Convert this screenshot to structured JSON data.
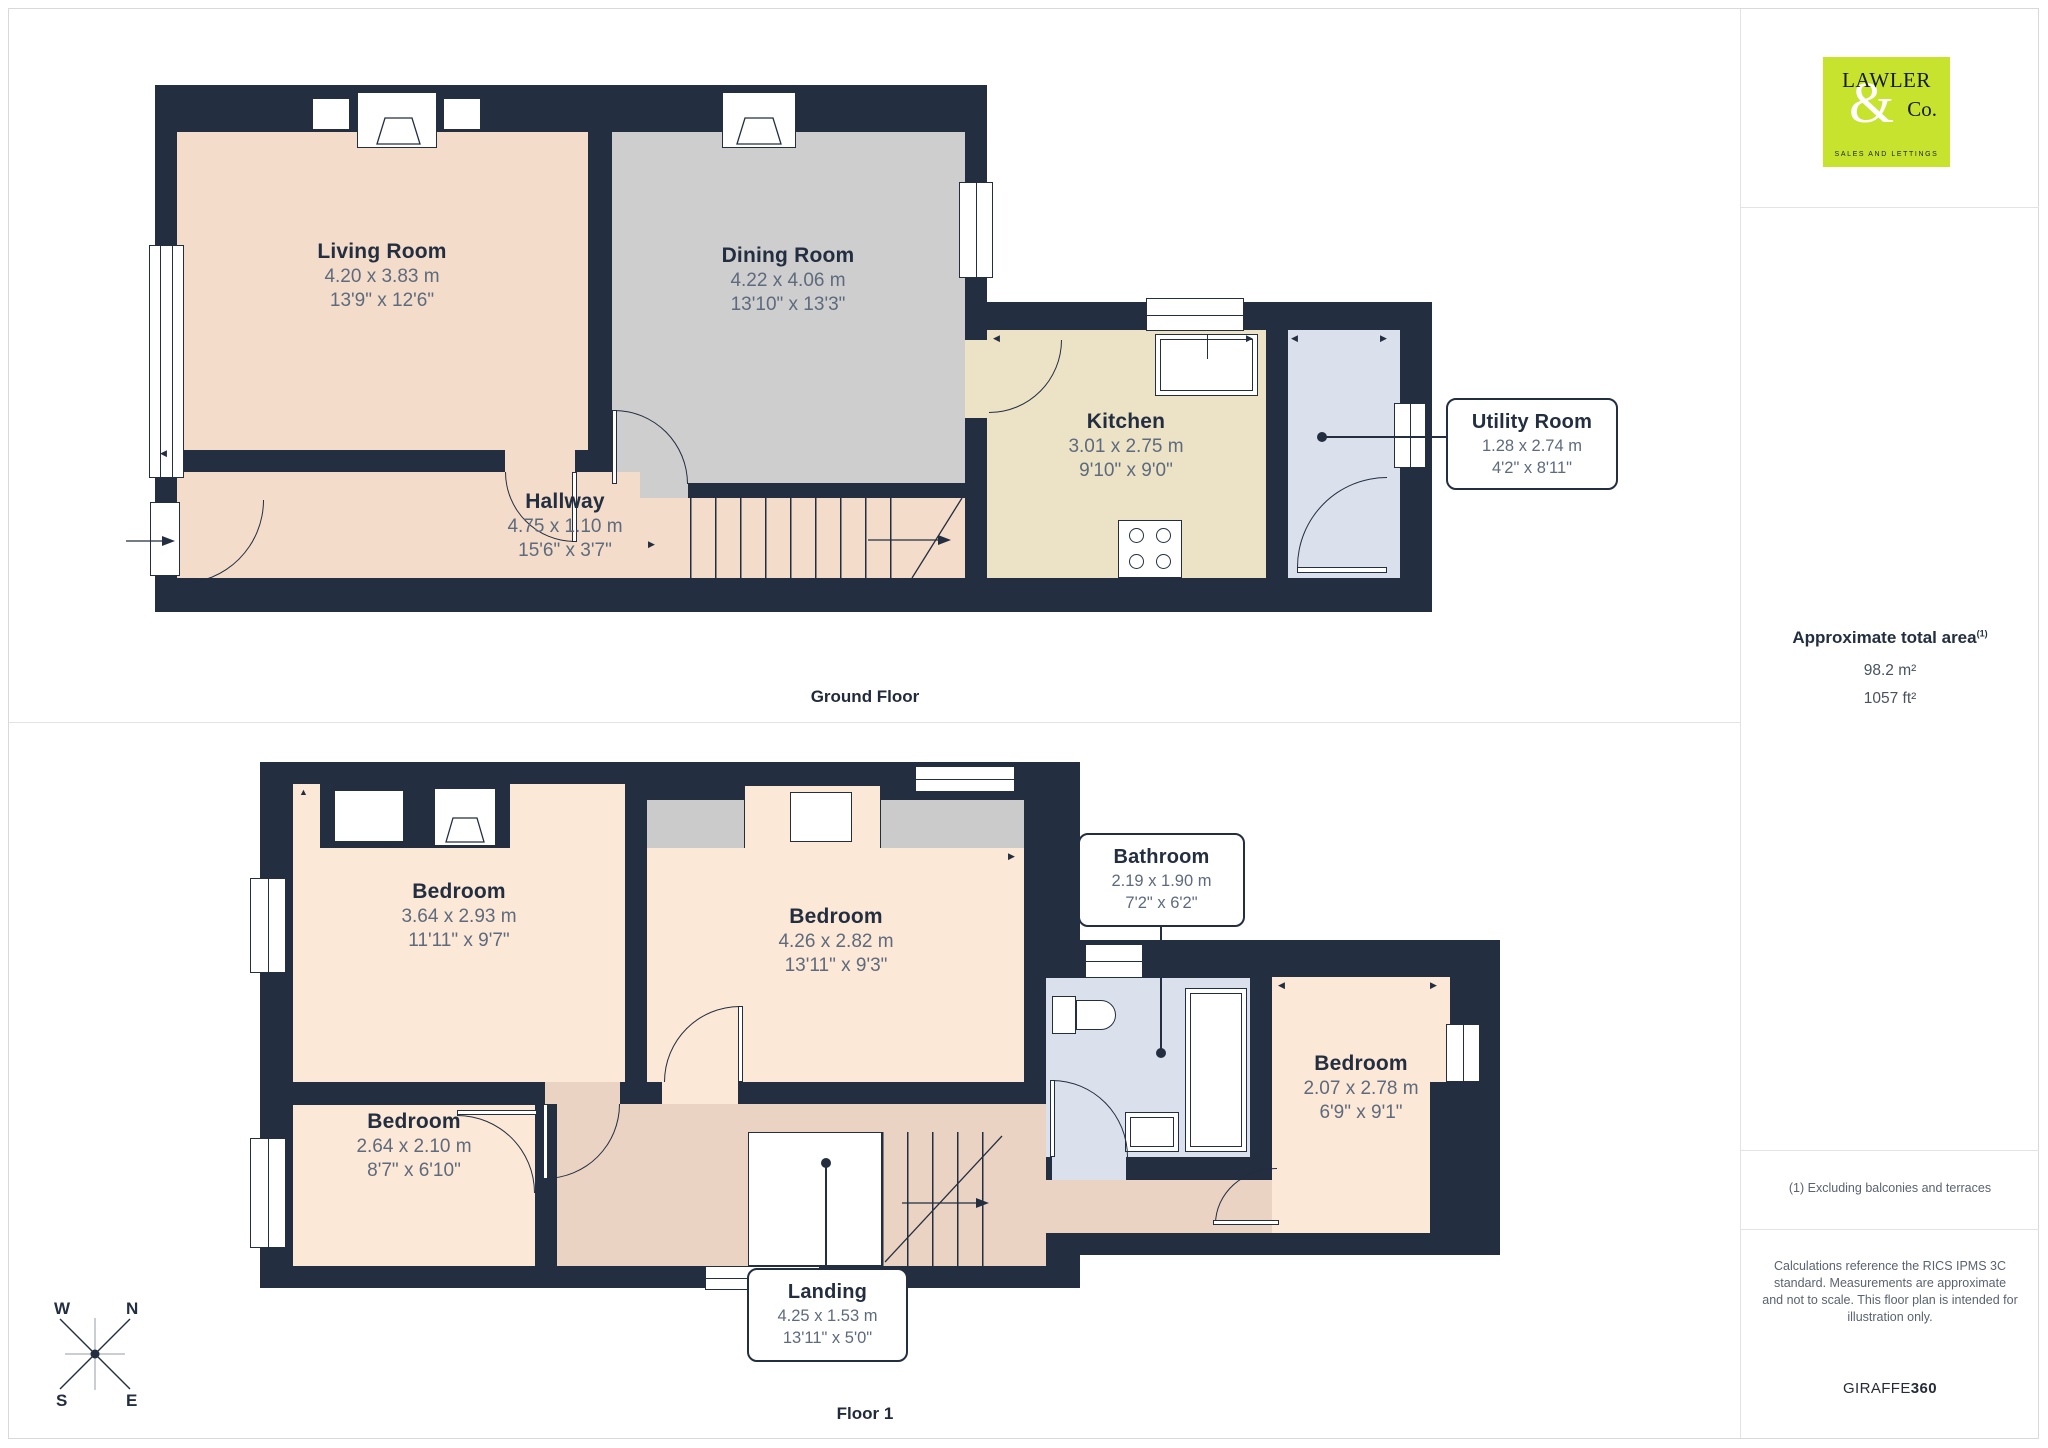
{
  "brand": {
    "name_top": "LAWLER",
    "ampersand": "&",
    "name_co": "Co.",
    "tagline": "SALES AND LETTINGS",
    "bg_color": "#c7e32d"
  },
  "sidebar": {
    "area_title": "Approximate total area",
    "area_note_ref": "(1)",
    "area_metric": "98.2 m²",
    "area_imperial": "1057 ft²",
    "footnote": "(1) Excluding balconies and terraces",
    "disclaimer": "Calculations reference the RICS IPMS 3C standard. Measurements are approximate and not to scale. This floor plan is intended for illustration only.",
    "credit_brand": "GIRAFFE",
    "credit_suffix": "360"
  },
  "ground_floor": {
    "label": "Ground Floor",
    "living_room": {
      "name": "Living Room",
      "metric": "4.20 x 3.83 m",
      "imperial": "13'9\" x 12'6\""
    },
    "dining_room": {
      "name": "Dining Room",
      "metric": "4.22 x 4.06 m",
      "imperial": "13'10\" x 13'3\""
    },
    "kitchen": {
      "name": "Kitchen",
      "metric": "3.01 x 2.75 m",
      "imperial": "9'10\" x 9'0\""
    },
    "hallway": {
      "name": "Hallway",
      "metric": "4.75 x 1.10 m",
      "imperial": "15'6\" x 3'7\""
    },
    "utility_room": {
      "name": "Utility Room",
      "metric": "1.28 x 2.74 m",
      "imperial": "4'2\" x 8'11\""
    }
  },
  "floor_1": {
    "label": "Floor 1",
    "bedroom_1": {
      "name": "Bedroom",
      "metric": "3.64 x 2.93 m",
      "imperial": "11'11\" x 9'7\""
    },
    "bedroom_2": {
      "name": "Bedroom",
      "metric": "4.26 x 2.82 m",
      "imperial": "13'11\" x 9'3\""
    },
    "bedroom_3": {
      "name": "Bedroom",
      "metric": "2.64 x 2.10 m",
      "imperial": "8'7\" x 6'10\""
    },
    "bedroom_4": {
      "name": "Bedroom",
      "metric": "2.07 x 2.78 m",
      "imperial": "6'9\" x 9'1\""
    },
    "bathroom": {
      "name": "Bathroom",
      "metric": "2.19 x 1.90 m",
      "imperial": "7'2\" x 6'2\""
    },
    "landing": {
      "name": "Landing",
      "metric": "4.25 x 1.53 m",
      "imperial": "13'11\" x 5'0\""
    }
  },
  "compass": {
    "n": "N",
    "e": "E",
    "s": "S",
    "w": "W"
  },
  "palette": {
    "wall": "#232e40",
    "living": "#f3dcca",
    "dining": "#cecece",
    "kitchen": "#ece3c7",
    "utility_bathroom": "#dbe1ec",
    "bedroom": "#fce8d6",
    "landing": "#ead3c3",
    "eaves": "#cbcbcb",
    "logo_bg": "#c7e32d"
  }
}
